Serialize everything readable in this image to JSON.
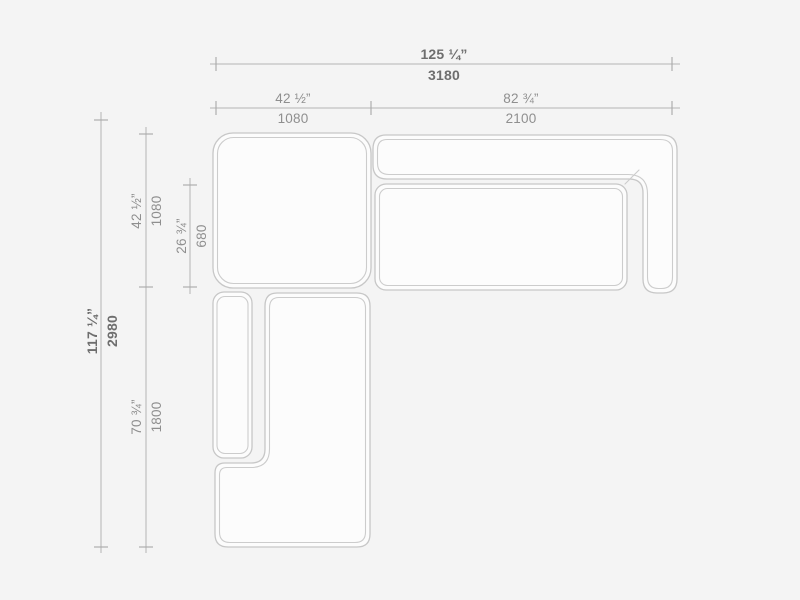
{
  "colors": {
    "background": "#f4f4f4",
    "furniture_fill": "#fcfcfc",
    "furniture_stroke": "#c7c7c7",
    "dimension_line": "#b3b3b3",
    "overall_label_text": "#6e6e6e",
    "segment_label_text": "#8f8f8f"
  },
  "dimensions": {
    "overall_width": {
      "inches": "125 ¼”",
      "mm": "3180"
    },
    "left_module_width": {
      "inches": "42 ½”",
      "mm": "1080"
    },
    "right_module_width": {
      "inches": "82 ¾”",
      "mm": "2100"
    },
    "overall_depth": {
      "inches": "117 ¼”",
      "mm": "2980"
    },
    "corner_module_depth": {
      "inches": "42 ½”",
      "mm": "1080"
    },
    "seat_depth": {
      "inches": "26 ¾”",
      "mm": "680"
    },
    "chaise_length": {
      "inches": "70 ¾”",
      "mm": "1800"
    }
  }
}
